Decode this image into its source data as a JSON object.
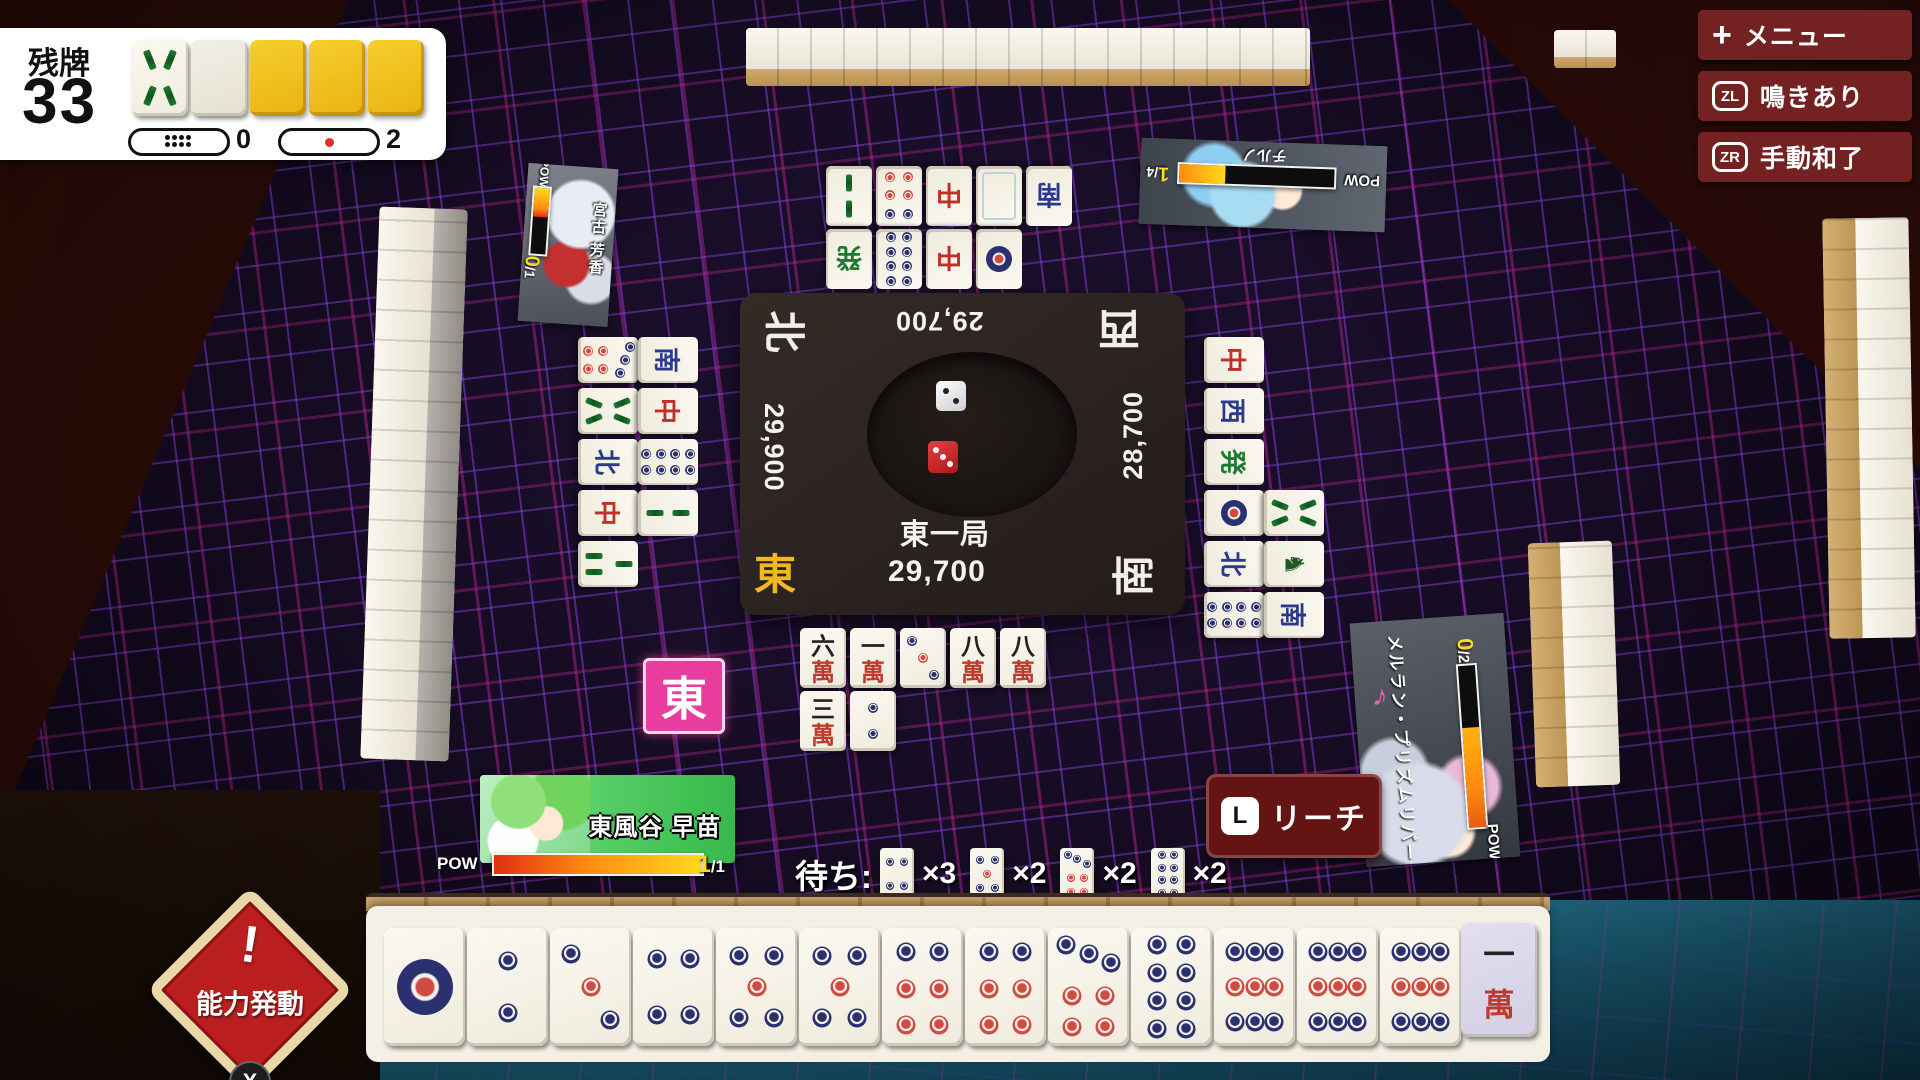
{
  "hud": {
    "remaining_label": "残牌",
    "remaining_count": "33",
    "dora_tiles": [
      "8s",
      "back-white",
      "back-gold",
      "back-gold",
      "back-gold"
    ],
    "honba_count": "0",
    "riichi_sticks_count": "2"
  },
  "menu": {
    "buttons": [
      {
        "icon": "plus-key",
        "icon_glyph": "+",
        "label": "メニュー"
      },
      {
        "icon": "zl-key",
        "icon_glyph": "ZL",
        "label": "鳴きあり"
      },
      {
        "icon": "zr-key",
        "icon_glyph": "ZR",
        "label": "手動和了"
      }
    ]
  },
  "board": {
    "round_label": "東一局",
    "scores": {
      "bottom": "29,700",
      "top": "29,700",
      "left": "29,900",
      "right": "28,700"
    },
    "winds": {
      "bottom": "東",
      "top": "西",
      "left": "北",
      "right": "南"
    },
    "dice": [
      {
        "color": "white",
        "top_pips": 2
      },
      {
        "color": "red",
        "top_pips": 3
      }
    ]
  },
  "round_marker": "東",
  "players": {
    "bottom": {
      "name": "東風谷 早苗",
      "pow_label": "POW",
      "ability_current": "1",
      "ability_max": "/1"
    },
    "left": {
      "name": "宮古 芳香",
      "pow_label": "POW",
      "ability_current": "0",
      "ability_max": "/1"
    },
    "top": {
      "name": "チルノ",
      "pow_label": "POW",
      "ability_current": "1",
      "ability_max": "/4"
    },
    "right": {
      "name": "メルラン・プリズムリバー",
      "pow_label": "POW",
      "ability_current": "0",
      "ability_max": "/2",
      "note_icon": "♪"
    }
  },
  "riichi_button": {
    "key_label": "L",
    "label": "リーチ"
  },
  "ability_badge": {
    "exclaim": "!",
    "label": "能力発動",
    "key_label": "X"
  },
  "waits": {
    "label": "待ち:",
    "options": [
      {
        "tile": "4p",
        "count": "×3"
      },
      {
        "tile": "5p",
        "count": "×2"
      },
      {
        "tile": "7p",
        "count": "×2"
      },
      {
        "tile": "8p",
        "count": "×2"
      }
    ]
  },
  "hand": {
    "tiles": [
      "1p",
      "2p",
      "3p",
      "4p",
      "5p",
      "5p",
      "6p",
      "6p",
      "7p",
      "8p",
      "9p",
      "9p",
      "9p"
    ],
    "drawn": "1m"
  },
  "discards": {
    "top": [
      [
        "2s",
        "6p",
        "中",
        "白",
        "南"
      ],
      [
        "発",
        "8p",
        "中",
        "1p"
      ]
    ],
    "left": [
      [
        "7p",
        "南"
      ],
      [
        "8s",
        "中"
      ],
      [
        "北",
        "8p"
      ],
      [
        "中",
        "2s"
      ],
      [
        "3s"
      ]
    ],
    "right": [
      [
        "中"
      ],
      [
        "西"
      ],
      [
        "発"
      ],
      [
        "1p",
        "8s"
      ],
      [
        "北",
        "1s"
      ],
      [
        "8p",
        "南"
      ]
    ],
    "bottom": [
      [
        "6m",
        "1m",
        "3p",
        "8m",
        "8m"
      ],
      [
        "3m",
        "2p"
      ]
    ]
  },
  "colors": {
    "accent_pink": "#e83d9e",
    "menu_red": "#742121",
    "riichi_red": "#651414",
    "badge_red": "#bc1f1f",
    "gold_tile": "#f2c31f",
    "pow_orange": "#ff8c10",
    "pin_navy": "#2a3070",
    "pin_red": "#d24a42"
  }
}
